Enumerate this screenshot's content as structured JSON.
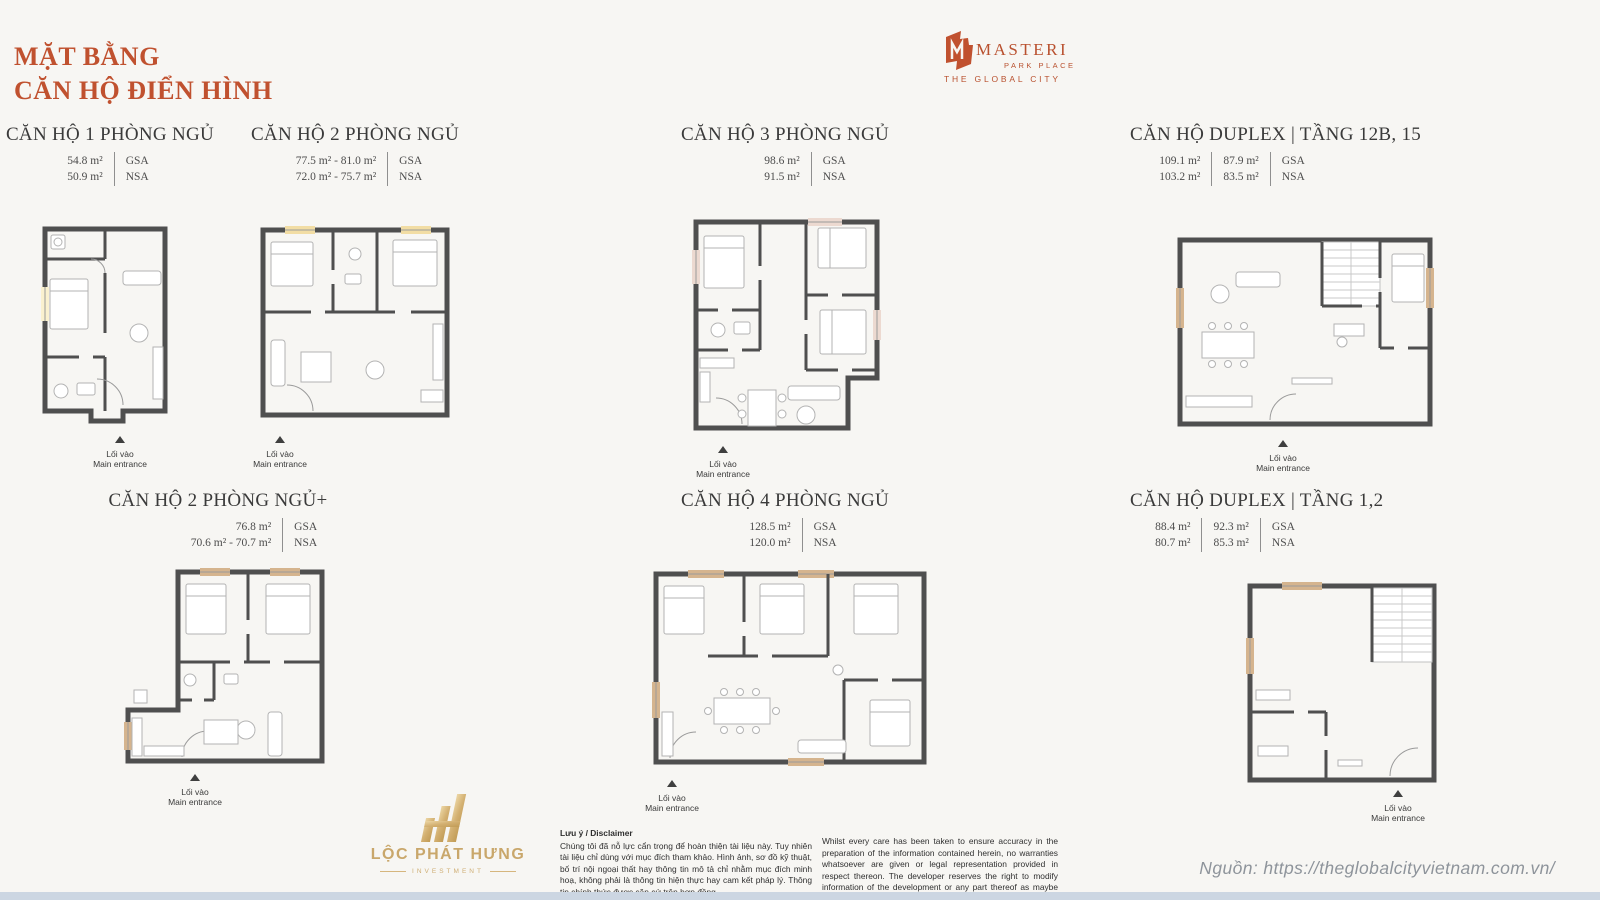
{
  "page": {
    "title_line1": "MẶT BẰNG",
    "title_line2": "CĂN HỘ ĐIỂN HÌNH",
    "background": "#f7f6f3",
    "accent": "#c0512f",
    "wall_color": "#4f4f4f",
    "bottom_strip_color": "#ccd6e2",
    "gold": "#c9a76b"
  },
  "brand": {
    "name": "MASTERI",
    "subtitle": "PARK PLACE",
    "tagline": "THE GLOBAL CITY"
  },
  "labels": {
    "gsa": "GSA",
    "nsa": "NSA",
    "entrance_vi": "Lối vào",
    "entrance_en": "Main entrance"
  },
  "units": [
    {
      "title": "CĂN HỘ 1 PHÒNG NGỦ",
      "gsa": [
        "54.8 m²"
      ],
      "nsa": [
        "50.9 m²"
      ],
      "fill": "#faf1cf"
    },
    {
      "title": "CĂN HỘ 2 PHÒNG NGỦ",
      "gsa": [
        "77.5 m² - 81.0 m²"
      ],
      "nsa": [
        "72.0 m² - 75.7 m²"
      ],
      "fill": "#f2dda4"
    },
    {
      "title": "CĂN HỘ 3 PHÒNG NGỦ",
      "gsa": [
        "98.6 m²"
      ],
      "nsa": [
        "91.5 m²"
      ],
      "fill": "#ecd9d0"
    },
    {
      "title": "CĂN HỘ DUPLEX | TẦNG 12B, 15",
      "gsa": [
        "109.1 m²",
        "87.9 m²"
      ],
      "nsa": [
        "103.2 m²",
        "83.5 m²"
      ],
      "fill": "#d5b48e"
    },
    {
      "title": "CĂN HỘ 2 PHÒNG NGỦ+",
      "gsa": [
        "76.8 m²"
      ],
      "nsa": [
        "70.6 m² - 70.7 m²"
      ],
      "fill": "#d5b48e"
    },
    {
      "title": "CĂN HỘ 4 PHÒNG NGỦ",
      "gsa": [
        "128.5 m²"
      ],
      "nsa": [
        "120.0 m²"
      ],
      "fill": "#d5b48e"
    },
    {
      "title": "CĂN HỘ DUPLEX | TẦNG 1,2",
      "gsa": [
        "88.4 m²",
        "92.3 m²"
      ],
      "nsa": [
        "80.7 m²",
        "85.3 m²"
      ],
      "fill": "#d5b48e"
    }
  ],
  "disclaimer": {
    "heading": "Lưu ý / Disclaimer",
    "vi": "Chúng tôi đã nỗ lực cẩn trọng để hoàn thiện tài liệu này. Tuy nhiên tài liệu chỉ dùng với mục đích tham khảo. Hình ảnh, sơ đồ kỹ thuật, bố trí nội ngoại thất hay thông tin mô tả chỉ nhằm mục đích minh hoạ, không phải là thông tin hiện thực hay cam kết pháp lý. Thông tin chính thức được căn cứ trên hợp đồng.",
    "en": "Whilst every care has been taken to ensure accuracy in the preparation of the information contained herein, no warranties whatsoever are given or legal representation provided in respect thereon. The developer reserves the right to modify information of the development or any part thereof as maybe approved or required by the relevant authorities."
  },
  "footer": {
    "logo_name": "LỘC PHÁT HƯNG",
    "logo_sub": "INVESTMENT",
    "source": "Nguồn: https://theglobalcityvietnam.com.vn/"
  }
}
